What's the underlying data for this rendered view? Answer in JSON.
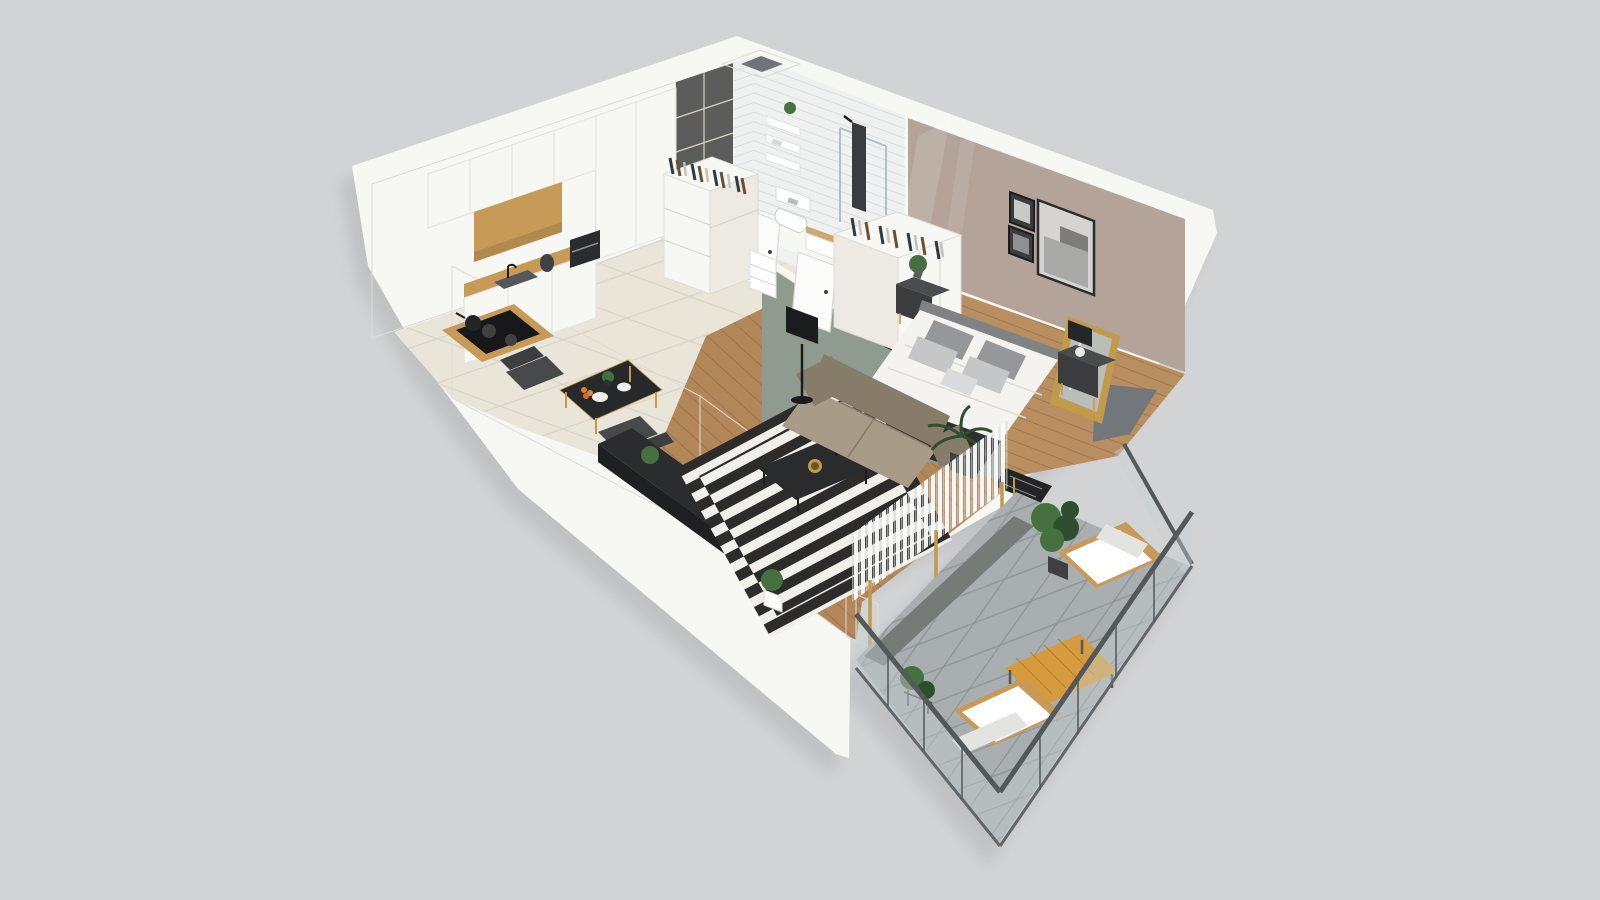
{
  "meta": {
    "description": "Isometric dollhouse-style 3D rendering of a one-bedroom apartment floor plan with balcony",
    "view": "cutaway top-down 3D floor plan",
    "visible_text": "none"
  },
  "colors": {
    "bg": "#d2d3d4",
    "shadow": "#b3b4b6",
    "wall": "#f7f7f4",
    "wall_shade": "#eceae3",
    "wall_edge": "#dddcd6",
    "door": "#fbfbf9",
    "tile": "#e9e5d9",
    "grout": "#d8d2c2",
    "wood": "#b2875a",
    "wood_line": "#8a6238",
    "bed_wood": "#b98e60",
    "mauve": "#b3a398",
    "sage": "#909b8f",
    "subway": "#eef1f0",
    "subway_line": "#d8dddc",
    "dark_tile": "#5c5d5b",
    "rug_dark": "#2d2c2a",
    "rug_light": "#f0efea",
    "sofa": "#a89b87",
    "sofa_dark": "#877b69",
    "cream": "#f4f3ef",
    "charcoal": "#2e2f31",
    "black": "#1b1c1e",
    "dark_gray": "#3f4143",
    "mid_gray": "#9b9da0",
    "pillow_light": "#c4c6c8",
    "wood_accent": "#c79a58",
    "orange": "#d69b3e",
    "bal_floor": "#a9aeb0",
    "bal_line": "#8d9295",
    "rail": "#53585b",
    "glass": "#c7d1d4",
    "green": "#45703f",
    "green_dark": "#2d4f2e",
    "gold": "#c29a4c",
    "photo_dark": "#3a3c3e",
    "photo_light": "#d5d4d1"
  },
  "scene": {
    "rooms": [
      {
        "name": "Kitchen",
        "items": [
          "white-cabinets",
          "wood-niche-shelf",
          "coffee-machine",
          "kettle",
          "sink",
          "cooktop",
          "dining-table",
          "dining-chairs"
        ]
      },
      {
        "name": "Hallway",
        "items": [
          "entry-door",
          "dresser-with-clothes-rail",
          "bathroom-door",
          "bedroom-door"
        ]
      },
      {
        "name": "Bathroom",
        "items": [
          "duct-shaft",
          "dark-accent-tiles",
          "subway-tiles",
          "wall-shelves",
          "toilet",
          "washbasin",
          "shower"
        ]
      },
      {
        "name": "Bedroom",
        "items": [
          "double-bed",
          "wardrobe-with-clothes",
          "tv",
          "nightstands",
          "table-lamp",
          "wall-art",
          "leaning-mirror",
          "bench",
          "plant"
        ]
      },
      {
        "name": "Living room",
        "items": [
          "sofa",
          "striped-rug",
          "coffee-table",
          "media-console",
          "floor-lamp",
          "curtain-wall",
          "plants",
          "side-stool"
        ]
      },
      {
        "name": "Balcony",
        "items": [
          "glass-railing",
          "lounge-chairs",
          "wooden-coffee-table",
          "potted-plants",
          "concrete-tile-floor"
        ]
      }
    ]
  }
}
